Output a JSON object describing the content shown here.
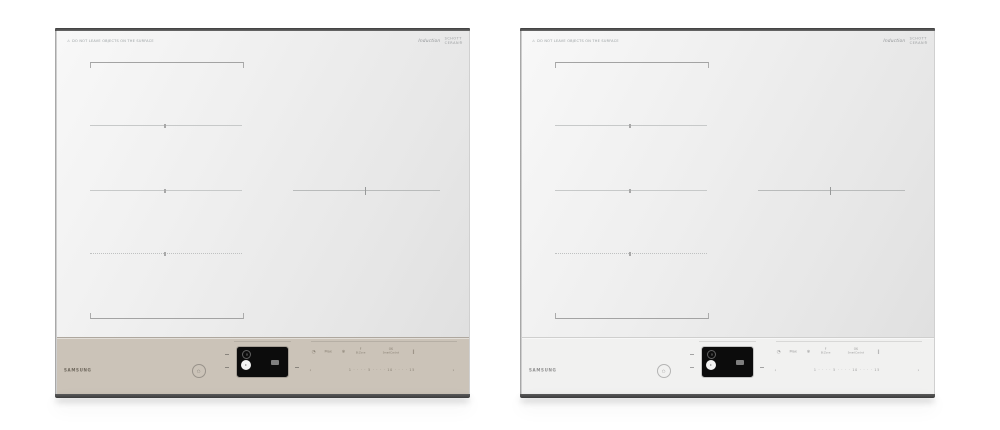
{
  "scene": {
    "background": "#ffffff"
  },
  "cooktop": {
    "warning_icon": "⚠",
    "warning_text": "DO NOT LEAVE OBJECTS ON THE SURFACE",
    "induction_label": "Induction",
    "glass_brand_line1": "SCHOTT",
    "glass_brand_line2": "CERAN®",
    "brand": "SAMSUNG",
    "power_glyph": "○",
    "display": {
      "zone_indicator": "8",
      "power_dot": "•"
    },
    "quick_controls": [
      {
        "name": "timer",
        "glyph": "◔"
      },
      {
        "name": "max-boost",
        "label": "Max"
      },
      {
        "name": "keep-warm",
        "glyph": "❄"
      },
      {
        "name": "flex-zone",
        "label": "F",
        "caption": "Bl.Zone"
      },
      {
        "name": "smart-control",
        "label": "OK",
        "caption": "SmartControl"
      },
      {
        "name": "pause",
        "glyph": "‖"
      }
    ],
    "slider": {
      "prev": "‹",
      "ticks": "1 · · · · 5 · · · · 10 · · · · 15",
      "next": "›"
    }
  },
  "units": [
    {
      "variant": "beige-panel",
      "panel_color": "#cbc3b8"
    },
    {
      "variant": "white-panel",
      "panel_color": "#f1f1f0"
    }
  ]
}
